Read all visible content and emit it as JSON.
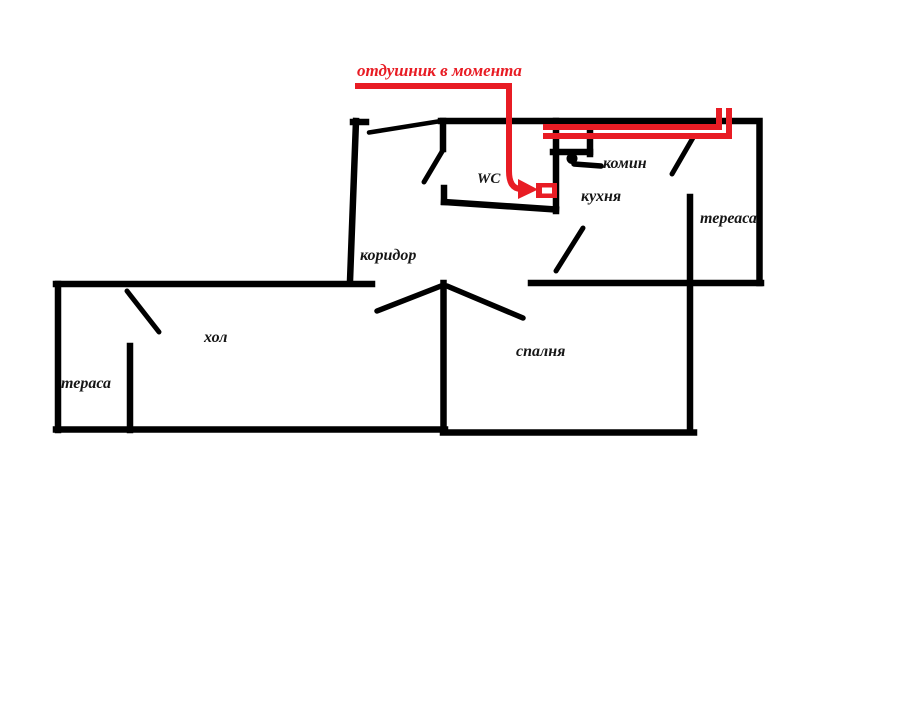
{
  "colors": {
    "wall": "#000000",
    "annotation": "#e81c24",
    "label_text": "#161616",
    "background": "#ffffff"
  },
  "annotations": {
    "vent_note": "отдушник в момента"
  },
  "rooms": {
    "wc": "WC",
    "chimney": "комин",
    "kitchen": "кухня",
    "terrace_right": "тереаса",
    "corridor": "коридор",
    "living_room": "хол",
    "bedroom": "спалня",
    "terrace_left": "тераса"
  }
}
